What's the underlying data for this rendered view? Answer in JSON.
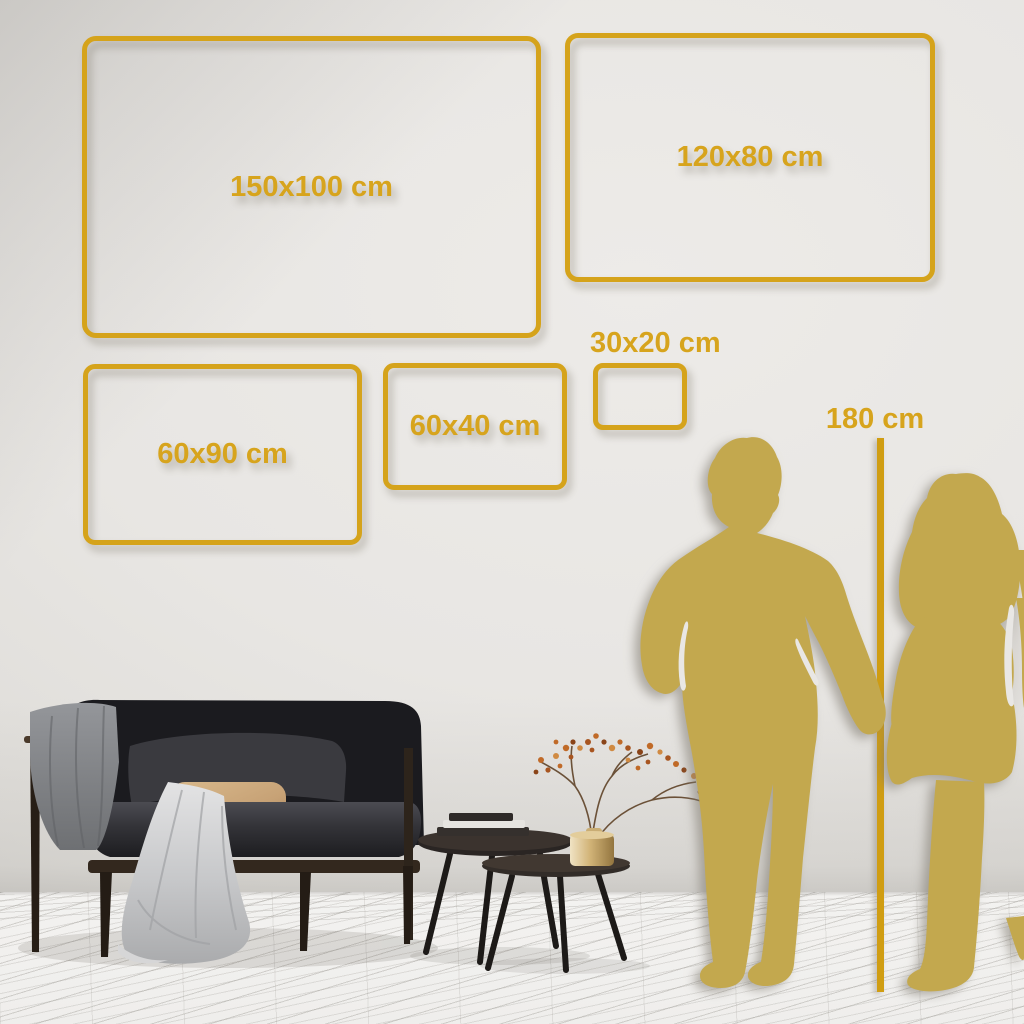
{
  "size_frames": [
    {
      "label": "150x100 cm"
    },
    {
      "label": "120x80 cm"
    },
    {
      "label": "60x90 cm"
    },
    {
      "label": "60x40 cm"
    },
    {
      "label": "30x20 cm"
    }
  ],
  "height_reference": {
    "label": "180 cm"
  },
  "colors": {
    "frame_gold": "#d5a31b",
    "label_gold": "#d7a41d",
    "line_gold": "#d09d12",
    "silhouette_gold": "#c3a84e",
    "wall": "#e8e6e3",
    "floor": "#f2f1ef"
  }
}
